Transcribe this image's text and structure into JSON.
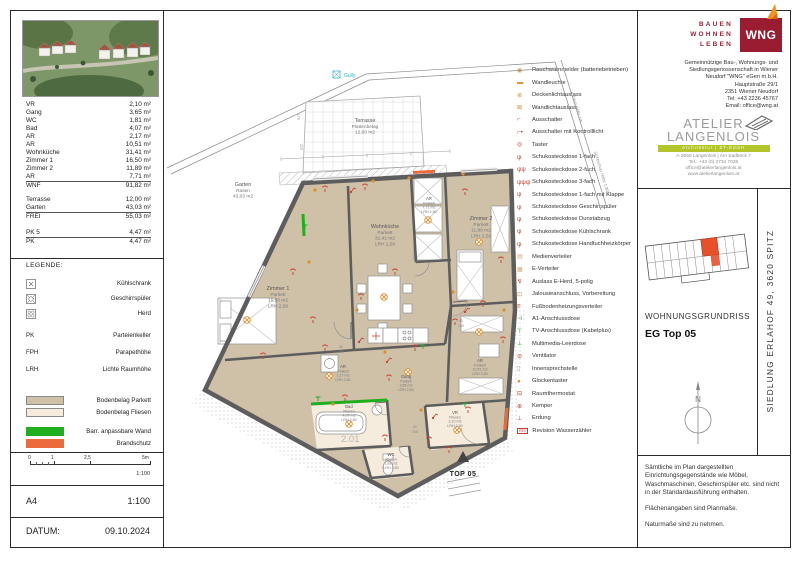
{
  "sheet": {
    "format": "A4",
    "scale": "1:100",
    "date_label": "DATUM:",
    "date": "09.10.2024",
    "scalebar": {
      "t0": "0",
      "t1": "1",
      "t2": "2,5",
      "t3": "5m",
      "ratio": "1:100"
    }
  },
  "area_table": {
    "rows": [
      {
        "label": "VR",
        "value": "2,10 m²"
      },
      {
        "label": "Gang",
        "value": "3,65 m²"
      },
      {
        "label": "WC",
        "value": "1,81 m²"
      },
      {
        "label": "Bad",
        "value": "4,07 m²"
      },
      {
        "label": "AR",
        "value": "2,17 m²"
      },
      {
        "label": "AR",
        "value": "10,51 m²"
      },
      {
        "label": "Wohnküche",
        "value": "31,41 m²"
      },
      {
        "label": "Zimmer 1",
        "value": "16,50 m²"
      },
      {
        "label": "Zimmer 2",
        "value": "11,89 m²"
      },
      {
        "label": "AR",
        "value": "7,71 m²"
      },
      {
        "label": "WNF",
        "value": "91,82 m²"
      },
      {
        "label": "Terrasse",
        "value": "12,00 m²"
      },
      {
        "label": "Garten",
        "value": "43,03 m²"
      },
      {
        "label": "FREI",
        "value": "55,03 m²"
      },
      {
        "label": "PK 5",
        "value": "4,47 m²"
      },
      {
        "label": "PK",
        "value": "4,47 m²"
      }
    ]
  },
  "legend": {
    "title": "LEGENDE:",
    "items": [
      {
        "label": "Kühlschrank"
      },
      {
        "label": "Geschirrspüler"
      },
      {
        "label": "Herd"
      }
    ],
    "abbrevs": [
      {
        "key": "PK",
        "label": "Parteienkeller"
      },
      {
        "key": "FPH",
        "label": "Parapethöhe"
      },
      {
        "key": "LRH",
        "label": "Lichte Raumhöhe"
      }
    ],
    "swatches": [
      {
        "label": "Bodenbelag Parkett",
        "color": "#cfc1a8"
      },
      {
        "label": "Bodenbelag Fliesen",
        "color": "#f6ecdd"
      },
      {
        "label": "Barr. anpassbare Wand",
        "color": "#1eae1e"
      },
      {
        "label": "Brandschutz",
        "color": "#ed6a3c"
      }
    ]
  },
  "symbol_legend": {
    "items": [
      {
        "glyph": "◉",
        "label": "Rauchwarnmelder (batteriebetrieben)"
      },
      {
        "glyph": "▬",
        "label": "Wandleuchte"
      },
      {
        "glyph": "⊗",
        "label": "Deckenlichtauslass"
      },
      {
        "glyph": "⊠",
        "label": "Wandlichtauslass"
      },
      {
        "glyph": "⌐",
        "label": "Ausschalter"
      },
      {
        "glyph": "⌐•",
        "label": "Ausschalter mit Kontrolllicht"
      },
      {
        "glyph": "◎",
        "label": "Taster"
      },
      {
        "glyph": "ψ",
        "label": "Schukosteckdose 1-fach"
      },
      {
        "glyph": "ψψ",
        "label": "Schukosteckdose 2-fach"
      },
      {
        "glyph": "ψψψ",
        "label": "Schukosteckdose 3-fach"
      },
      {
        "glyph": "ψ",
        "label": "Schukosteckdose 1-fach mit Klappe"
      },
      {
        "glyph": "ψ",
        "label": "Schukosteckdose Geschirrspüler"
      },
      {
        "glyph": "ψ",
        "label": "Schukosteckdose Dunstabzug"
      },
      {
        "glyph": "ψ",
        "label": "Schukosteckdose Kühlschrank"
      },
      {
        "glyph": "ψ",
        "label": "Schukosteckdose Handtuchheizkörper"
      },
      {
        "glyph": "▤",
        "label": "Medienverteiler"
      },
      {
        "glyph": "▦",
        "label": "E-Verteiler"
      },
      {
        "glyph": "↯",
        "label": "Auslass E-Herd, 5-polig"
      },
      {
        "glyph": "⊡",
        "label": "Jalousieanschluss, Vorbereitung"
      },
      {
        "glyph": "≡",
        "label": "Fußbodenheizungsverteiler"
      },
      {
        "glyph": "⊣",
        "label": "A1-Anschlussdose"
      },
      {
        "glyph": "⊤",
        "label": "TV-Anschlussdose (Kabelplus)"
      },
      {
        "glyph": "⊥",
        "label": "Multimedia-Leerdose"
      },
      {
        "glyph": "⊘",
        "label": "Ventilator"
      },
      {
        "glyph": "▯",
        "label": "Innensprechstelle"
      },
      {
        "glyph": "●",
        "label": "Glockentaster"
      },
      {
        "glyph": "⊟",
        "label": "Raumthermostat"
      },
      {
        "glyph": "⊕",
        "label": "Kemper"
      },
      {
        "glyph": "⊥",
        "label": "Erdung"
      },
      {
        "glyph": "REV",
        "label": "Revision Wasserzähler"
      }
    ]
  },
  "wng": {
    "tagline": [
      "BAUEN",
      "WOHNEN",
      "LEBEN"
    ],
    "logo": "WNG",
    "address": [
      "Gemeinnützige Bau-, Wohnungs- und",
      "Siedlungsgenossenschaft in Wiener",
      "Neudorf \"WNG\" eGen m.b.H.",
      "Hauptstraße 29/1",
      "2351 Wiener Neudorf",
      "Tel:       +43 2236 45767",
      "Email:   office@wng.at"
    ]
  },
  "atelier": {
    "name1": "ATELIER",
    "name2": "LANGENLOIS",
    "bar": "Architektur  |  ZT-GmbH",
    "address": [
      "A-3550 Langenlois | Am Sadbeck 7",
      "Tel.: +43 (0) 2734 7026",
      "office@atelierlangenlois.at",
      "www.atelierlangenlois.at"
    ]
  },
  "titles": {
    "type": "WOHNUNGSGRUNDRISS",
    "unit": "EG Top 05",
    "project": "SIEDLUNG ERLAHOF 49, 3620 SPITZ",
    "north": "N"
  },
  "notes": {
    "p1": "Sämtliche im Plan dargestellten Einrichtungsgegenstände wie Möbel, Waschmaschinen, Geschirrspüler etc. sind nicht in der Standardausführung enthalten.",
    "p2": "Flächenangaben sind Planmaße.",
    "p3": "Naturmaße sind zu nehmen."
  },
  "plan": {
    "rooms": {
      "terrasse": {
        "lines": [
          "Terrasse",
          "Plattenbelag",
          "12,00 m2"
        ]
      },
      "garten": {
        "lines": [
          "Garten",
          "Rasen",
          "43,03 m2"
        ]
      },
      "wohnkueche": {
        "lines": [
          "Wohnküche",
          "Parkett",
          "31,41 m2",
          "LRH 2,50"
        ]
      },
      "zimmer1": {
        "lines": [
          "Zimmer 1",
          "Parkett",
          "16,50 m2",
          "LRH 2,50"
        ]
      },
      "zimmer2": {
        "lines": [
          "Zimmer 2",
          "Parkett",
          "11,89 m2",
          "LRH 2,50"
        ]
      },
      "ar_klein": {
        "lines": [
          "AR",
          "Parkett",
          "2,17 m2",
          "LRH 2,50"
        ]
      },
      "ar_gross": {
        "lines": [
          "AR",
          "Parkett",
          "10,51 m2",
          "LRH 2,50"
        ]
      },
      "ar_schrank": {
        "lines": [
          "AR",
          "Parkett",
          "7,71 m2",
          "LRH 2,50"
        ]
      },
      "bad": {
        "lines": [
          "Bad",
          "Fliesen",
          "4,07 m2",
          "LRH 2,50"
        ]
      },
      "wc": {
        "lines": [
          "WC",
          "Fliesen",
          "1,81 m2",
          "LRH 2,50"
        ]
      },
      "gang": {
        "lines": [
          "Gang",
          "Parkett",
          "3,65 m2",
          "LRH 2,50"
        ]
      },
      "vr": {
        "lines": [
          "VR",
          "Fliesen",
          "2,10 m2",
          "LRH 2,50"
        ]
      }
    },
    "top_label": "TOP 05",
    "level_mark": "2.01",
    "gully": "Gully",
    "fence1": "Zaun Höhe 1m",
    "fence2": "Sichtschutz Höhe 1,80m",
    "door_w": "80",
    "door_h": "200",
    "dim1": "170",
    "dim2": "210"
  }
}
